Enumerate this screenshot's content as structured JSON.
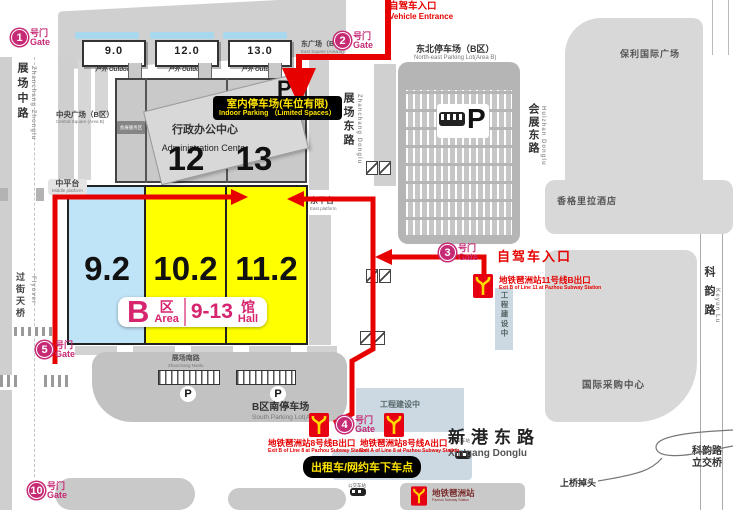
{
  "colors": {
    "route_red": "#e60000",
    "gate_pink": "#c62a74",
    "hall_yellow": "#ffff00",
    "hall_blue": "#bfe3f7",
    "metro_red": "#e60012",
    "metro_yellow": "#ffd900",
    "badge_pink": "#d6246e",
    "highlight_label_bg": "#000000",
    "highlight_label_text": "#ffe400"
  },
  "top_entrance": {
    "zh": "自驾车入口",
    "en": "Vehicle Entrance"
  },
  "outdoor_blocks": [
    {
      "num": "9.0",
      "zh": "户外",
      "en": "Outdoor"
    },
    {
      "num": "12.0",
      "zh": "户外",
      "en": "Outdoor"
    },
    {
      "num": "13.0",
      "zh": "户外",
      "en": "Outdoor"
    }
  ],
  "east_square": {
    "zh": "东广场（B区）",
    "en": "East Square (Area B)"
  },
  "central_square": {
    "zh": "中央广场（B区）",
    "en": "Central Square (Area B)"
  },
  "gates": [
    {
      "num": "1",
      "zh": "号门",
      "en": "Gate"
    },
    {
      "num": "2",
      "zh": "号门",
      "en": "Gate"
    },
    {
      "num": "3",
      "zh": "号门",
      "en": "Gate"
    },
    {
      "num": "4",
      "zh": "号门",
      "en": "Gate"
    },
    {
      "num": "5",
      "zh": "号门",
      "en": "Gate"
    },
    {
      "num": "10",
      "zh": "号门",
      "en": "Gate"
    }
  ],
  "building": {
    "admin_zh": "行政办公中心",
    "admin_en": "Administration Center",
    "hall_12": "12",
    "hall_13": "13",
    "parking_p": "P",
    "mini_label_zh": "会展服务区"
  },
  "indoor_parking": {
    "zh": "室内停车场(车位有限)",
    "en": "Indoor Parking （Limited Spaces）"
  },
  "halls": {
    "h1": "9.2",
    "h2": "10.2",
    "h3": "11.2"
  },
  "area_badge": {
    "b": "B",
    "qu": "区",
    "area": "Area",
    "range": "9-13",
    "guan": "馆",
    "hall": "Hall"
  },
  "platforms": {
    "middle": {
      "zh": "中平台",
      "en": "Middle platform"
    },
    "east": {
      "zh": "东平台",
      "en": "East platform"
    }
  },
  "roads": {
    "zhanchang_zhonglu": {
      "zh": "展场中路",
      "en": "Zhanchang Zhonglu"
    },
    "zhanchang_donglu": {
      "zh": "展场东路",
      "en": "Zhanchang Donglu"
    },
    "huizhan_donglu": {
      "zh": "会展东路",
      "en": "Huizhan Donglu"
    },
    "keyun_lu": {
      "zh": "科韵路",
      "en": "Keyun Lu"
    },
    "xingang_donglu": {
      "zh": "新港东路",
      "en": "Xin'gang Donglu"
    },
    "zhanchang_nanlu": {
      "zh": "展场南路",
      "en": "Zhanchang Nanlu"
    },
    "flyover": {
      "zh": "过街天桥",
      "en": "Flyover"
    },
    "keyun_interchange": {
      "line1": "科韵路",
      "line2": "立交桥"
    },
    "u_turn": "上桥掉头"
  },
  "places": {
    "ne_parking": {
      "zh": "东北停车场（B区）",
      "en": "North-east Parking Lot(Area B)"
    },
    "south_parking": {
      "zh": "B区南停车场",
      "en": "South Parking Lot(Area B)"
    },
    "poly_plaza": "保利国际广场",
    "shangri_la": "香格里拉酒店",
    "sourcing_center": "国际采购中心",
    "construction_1": "工程建设中",
    "construction_2": "工程建设中"
  },
  "metro": {
    "line11_exit_b": {
      "zh": "地铁琶洲站11号线B出口",
      "en": "Exit B of Line 11 at Pazhou Subway Station"
    },
    "line8_exit_b": {
      "zh": "地铁琶洲站8号线B出口",
      "en": "Exit B of Line 8 at Pazhou Subway Station"
    },
    "line8_exit_a": {
      "zh": "地铁琶洲站8号线A出口",
      "en": "Exit A of Line 8 at Pazhou Subway Station"
    },
    "station": {
      "zh": "地铁琶洲站",
      "en": "Pazhou Subway Station"
    }
  },
  "gate3_entrance": "自驾车入口",
  "taxi_dropoff": "出租车/网约车下车点",
  "bus_stop_label": "公交车站",
  "parking_p": "P"
}
